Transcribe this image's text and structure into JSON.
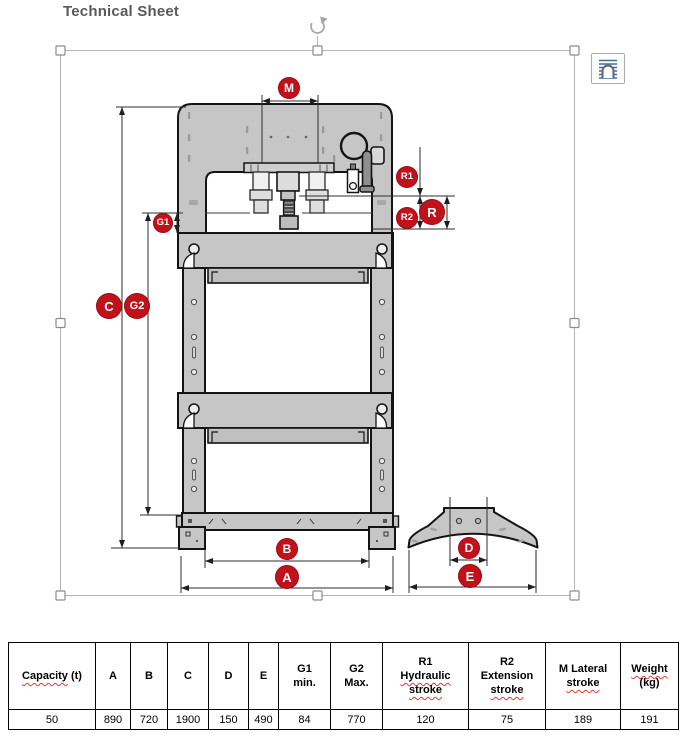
{
  "page": {
    "title": "Technical Sheet"
  },
  "diagram": {
    "label_color": "#c1121c",
    "labels": [
      {
        "id": "M",
        "text": "M",
        "x": 289,
        "y": 88,
        "r": 11
      },
      {
        "id": "G1",
        "text": "G1",
        "x": 163,
        "y": 223,
        "r": 10
      },
      {
        "id": "R1",
        "text": "R1",
        "x": 407,
        "y": 177,
        "r": 11
      },
      {
        "id": "R2",
        "text": "R2",
        "x": 407,
        "y": 218,
        "r": 11
      },
      {
        "id": "R",
        "text": "R",
        "x": 432,
        "y": 212,
        "r": 13
      },
      {
        "id": "C",
        "text": "C",
        "x": 109,
        "y": 306,
        "r": 13
      },
      {
        "id": "G2",
        "text": "G2",
        "x": 137,
        "y": 306,
        "r": 13
      },
      {
        "id": "B",
        "text": "B",
        "x": 287,
        "y": 549,
        "r": 11
      },
      {
        "id": "A",
        "text": "A",
        "x": 287,
        "y": 577,
        "r": 12
      },
      {
        "id": "D",
        "text": "D",
        "x": 469,
        "y": 548,
        "r": 11
      },
      {
        "id": "E",
        "text": "E",
        "x": 470,
        "y": 576,
        "r": 12
      }
    ]
  },
  "table": {
    "columns": [
      {
        "width": 87,
        "lines": [
          [
            {
              "t": "Capacity",
              "sp": true
            },
            {
              "t": " (t)"
            }
          ]
        ],
        "value": "50"
      },
      {
        "width": 35,
        "lines": [
          [
            {
              "t": "A"
            }
          ]
        ],
        "value": "890"
      },
      {
        "width": 37,
        "lines": [
          [
            {
              "t": "B"
            }
          ]
        ],
        "value": "720"
      },
      {
        "width": 41,
        "lines": [
          [
            {
              "t": "C"
            }
          ]
        ],
        "value": "1900"
      },
      {
        "width": 40,
        "lines": [
          [
            {
              "t": "D"
            }
          ]
        ],
        "value": "150"
      },
      {
        "width": 30,
        "lines": [
          [
            {
              "t": "E"
            }
          ]
        ],
        "value": "490"
      },
      {
        "width": 52,
        "lines": [
          [
            {
              "t": "G1"
            }
          ],
          [
            {
              "t": "min."
            }
          ]
        ],
        "value": "84"
      },
      {
        "width": 52,
        "lines": [
          [
            {
              "t": "G2"
            }
          ],
          [
            {
              "t": "Max."
            }
          ]
        ],
        "value": "770"
      },
      {
        "width": 86,
        "lines": [
          [
            {
              "t": "R1"
            }
          ],
          [
            {
              "t": "Hydraulic",
              "sp": true
            }
          ],
          [
            {
              "t": "stroke",
              "sp": true
            }
          ]
        ],
        "value": "120"
      },
      {
        "width": 77,
        "lines": [
          [
            {
              "t": "R2"
            }
          ],
          [
            {
              "t": "Extension"
            }
          ],
          [
            {
              "t": "stroke",
              "sp": true
            }
          ]
        ],
        "value": "75"
      },
      {
        "width": 75,
        "lines": [
          [
            {
              "t": "M Lateral"
            }
          ],
          [
            {
              "t": "stroke",
              "sp": true
            }
          ]
        ],
        "value": "189"
      },
      {
        "width": 58,
        "lines": [
          [
            {
              "t": "Weight",
              "sp": true
            }
          ],
          [
            {
              "t": "(kg)"
            }
          ]
        ],
        "value": "191"
      }
    ]
  }
}
